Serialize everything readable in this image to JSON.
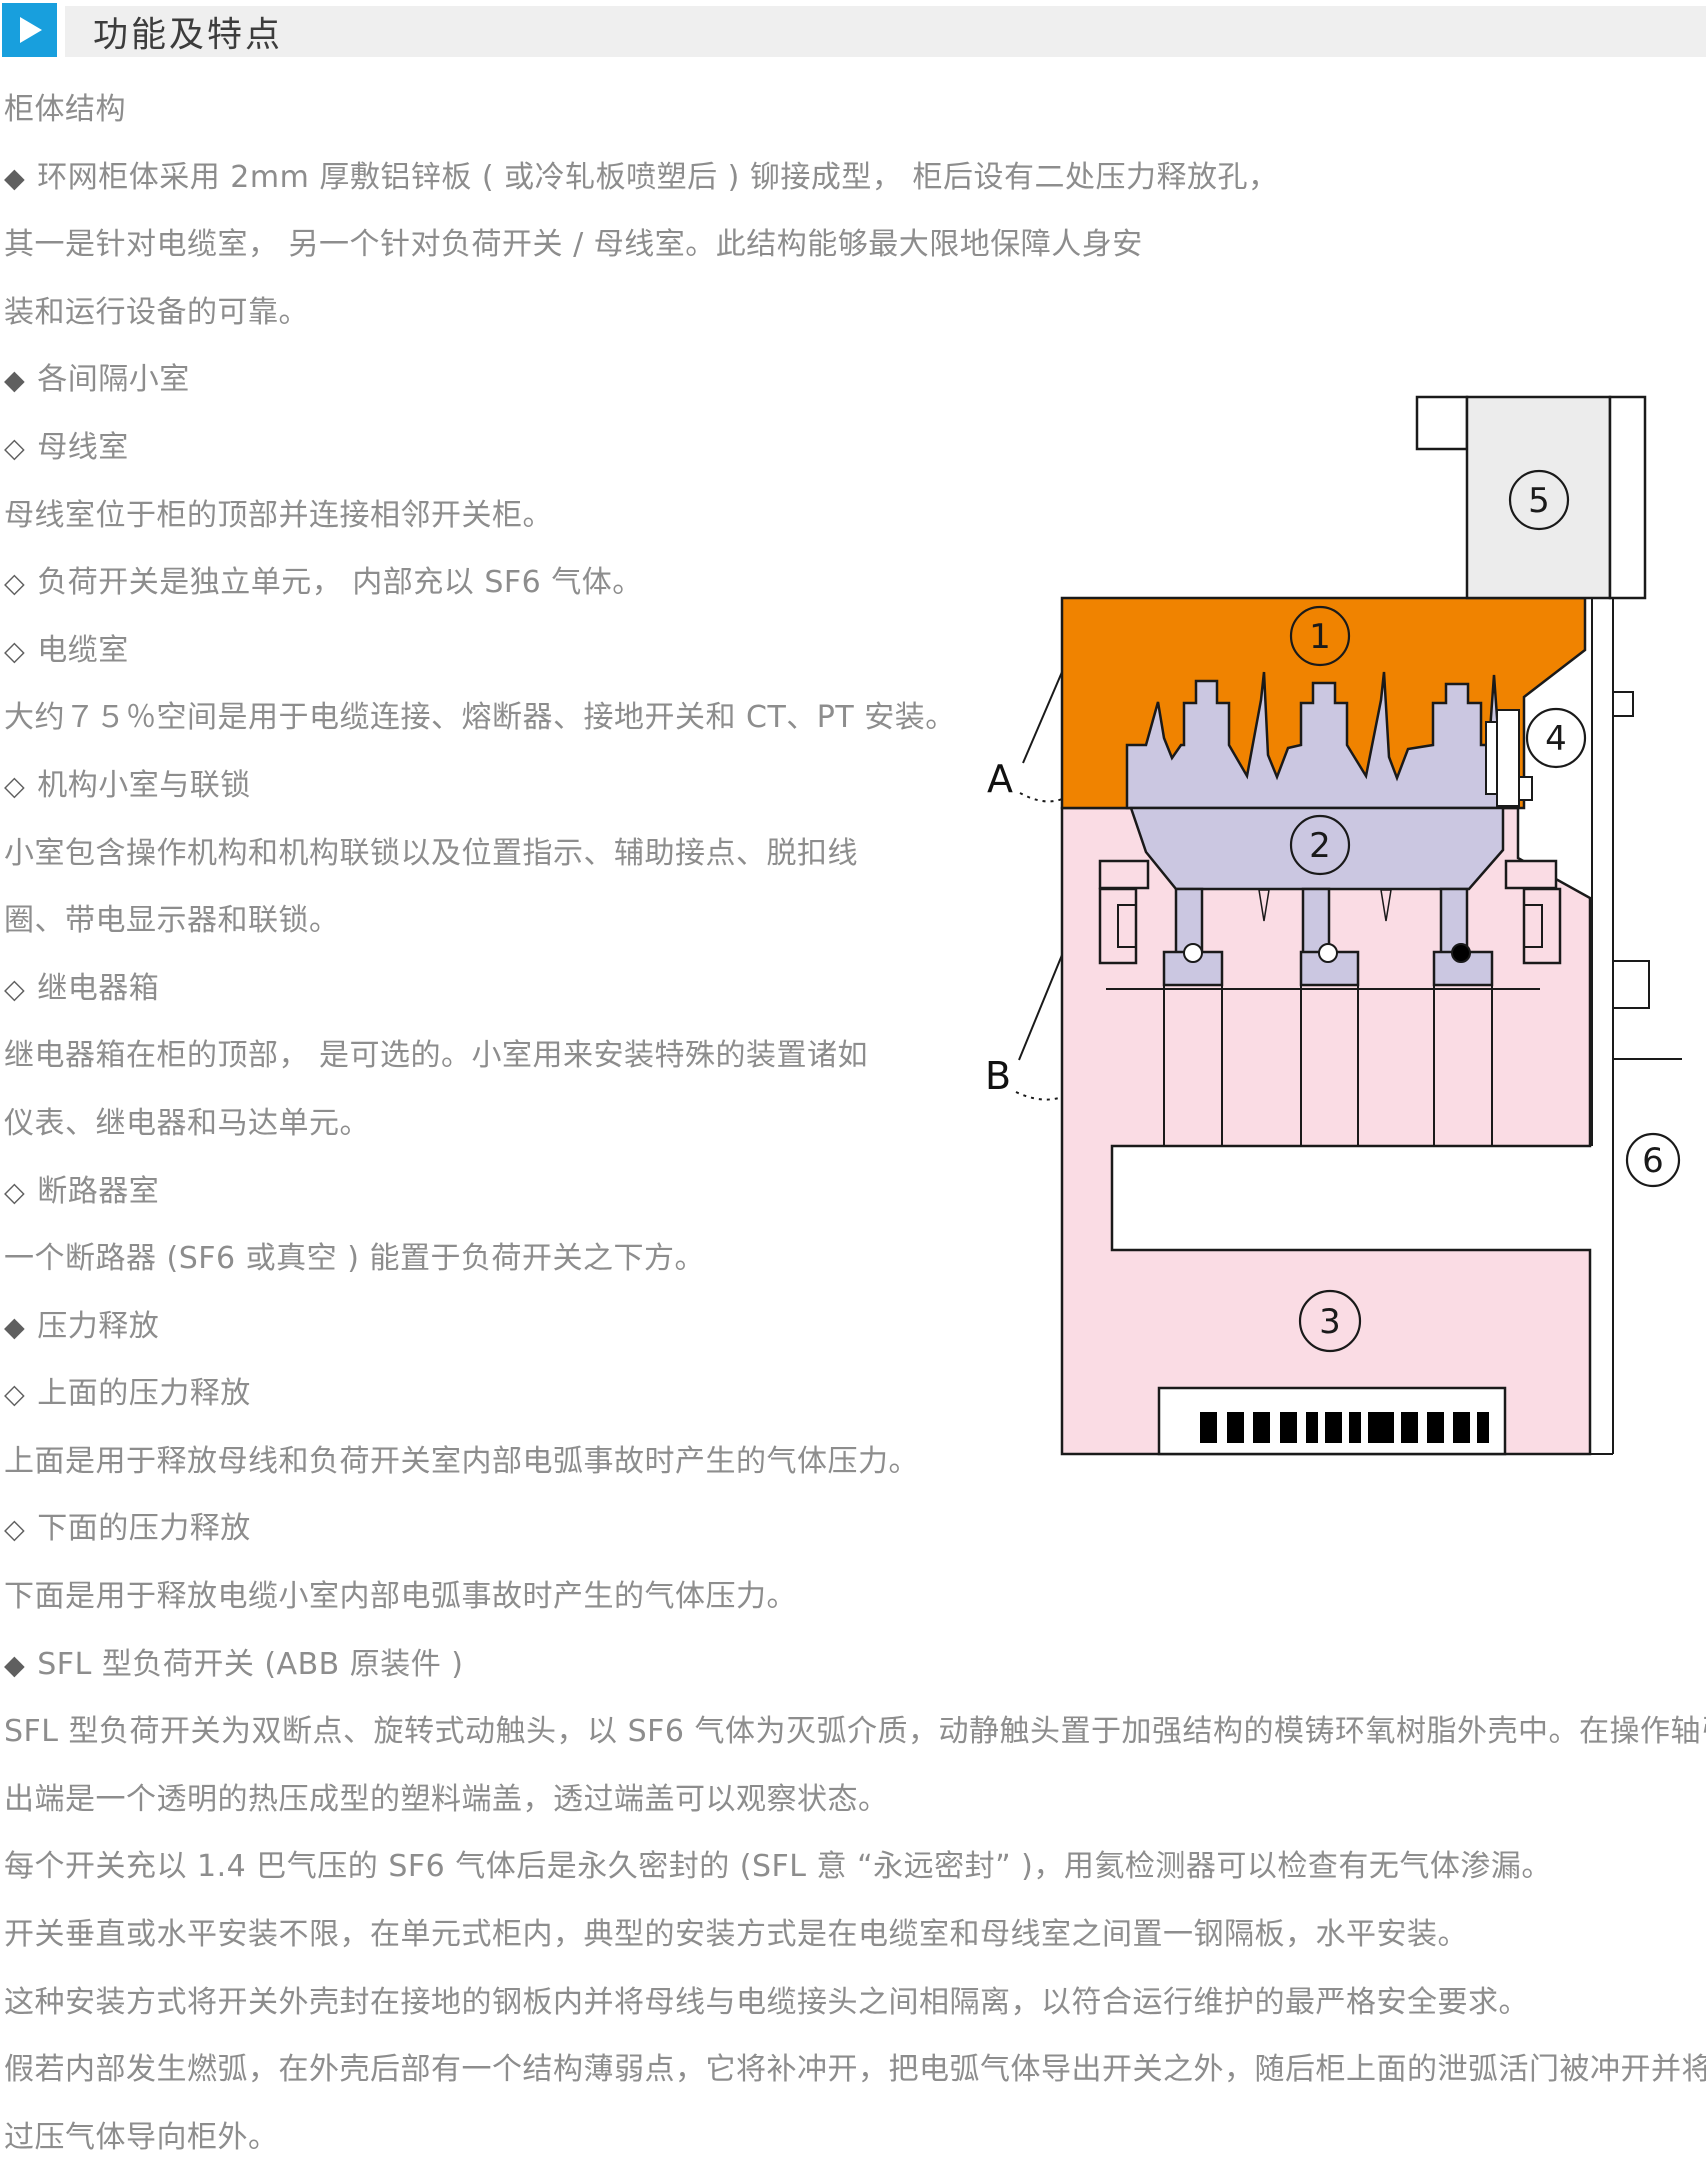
{
  "header": {
    "title": "功能及特点"
  },
  "content": {
    "lines": [
      {
        "bullet": "",
        "text": "柜体结构"
      },
      {
        "bullet": "◆",
        "text": "环网柜体采用 2mm 厚敷铝锌板 ( 或冷轧板喷塑后 ) 铆接成型， 柜后设有二处压力释放孔，"
      },
      {
        "bullet": "",
        "text": "其一是针对电缆室， 另一个针对负荷开关 / 母线室。此结构能够最大限地保障人身安"
      },
      {
        "bullet": "",
        "text": "装和运行设备的可靠。"
      },
      {
        "bullet": "◆",
        "text": "各间隔小室"
      },
      {
        "bullet": "◇",
        "text": "母线室"
      },
      {
        "bullet": "",
        "text": "母线室位于柜的顶部并连接相邻开关柜。"
      },
      {
        "bullet": "◇",
        "text": "负荷开关是独立单元， 内部充以 SF6 气体。"
      },
      {
        "bullet": "◇",
        "text": "电缆室"
      },
      {
        "bullet": "",
        "text": "大约７５％空间是用于电缆连接、熔断器、接地开关和 CT、PT 安装。"
      },
      {
        "bullet": "◇",
        "text": "机构小室与联锁"
      },
      {
        "bullet": "",
        "text": "小室包含操作机构和机构联锁以及位置指示、辅助接点、脱扣线"
      },
      {
        "bullet": "",
        "text": "圈、带电显示器和联锁。"
      },
      {
        "bullet": "◇",
        "text": "继电器箱"
      },
      {
        "bullet": "",
        "text": "继电器箱在柜的顶部， 是可选的。小室用来安装特殊的装置诸如"
      },
      {
        "bullet": "",
        "text": "仪表、继电器和马达单元。"
      },
      {
        "bullet": "◇",
        "text": "断路器室"
      },
      {
        "bullet": "",
        "text": "一个断路器 (SF6 或真空 ) 能置于负荷开关之下方。"
      },
      {
        "bullet": "◆",
        "text": "压力释放"
      },
      {
        "bullet": "◇",
        "text": "上面的压力释放"
      },
      {
        "bullet": "",
        "text": "上面是用于释放母线和负荷开关室内部电弧事故时产生的气体压力。"
      },
      {
        "bullet": "◇",
        "text": "下面的压力释放"
      },
      {
        "bullet": "",
        "text": "下面是用于释放电缆小室内部电弧事故时产生的气体压力。"
      },
      {
        "bullet": "◆",
        "text": "SFL 型负荷开关 (ABB 原装件 )"
      },
      {
        "bullet": "",
        "text": "SFL 型负荷开关为双断点、旋转式动触头，以 SF6 气体为灭弧介质，动静触头置于加强结构的模铸环氧树脂外壳中。在操作轴引"
      },
      {
        "bullet": "",
        "text": "出端是一个透明的热压成型的塑料端盖，透过端盖可以观察状态。"
      },
      {
        "bullet": "",
        "text": "每个开关充以 1.4 巴气压的 SF6 气体后是永久密封的 (SFL 意 “永远密封” )，用氦检测器可以检查有无气体渗漏。"
      },
      {
        "bullet": "",
        "text": "开关垂直或水平安装不限，在单元式柜内，典型的安装方式是在电缆室和母线室之间置一钢隔板，水平安装。"
      },
      {
        "bullet": "",
        "text": "这种安装方式将开关外壳封在接地的钢板内并将母线与电缆接头之间相隔离，以符合运行维护的最严格安全要求。"
      },
      {
        "bullet": "",
        "text": "假若内部发生燃弧，在外壳后部有一个结构薄弱点，它将补冲开，把电弧气体导出开关之外，随后柜上面的泄弧活门被冲开并将"
      },
      {
        "bullet": "",
        "text": "过压气体导向柜外。"
      }
    ]
  },
  "diagram": {
    "callouts": {
      "n1": "1",
      "n2": "2",
      "n3": "3",
      "n4": "4",
      "n5": "5",
      "n6": "6",
      "a": "A",
      "b": "B"
    },
    "colors": {
      "accent_blue": "#189FDD",
      "header_bar_gray": "#EFEFEF",
      "busbar_orange": "#F08300",
      "cable_room_pink": "#FADCE4",
      "switch_lavender": "#CBC7E1",
      "relay_box_gray": "#ECECEC",
      "outline_black": "#1A1A1A",
      "body_text_gray": "#8D8D8D"
    }
  }
}
